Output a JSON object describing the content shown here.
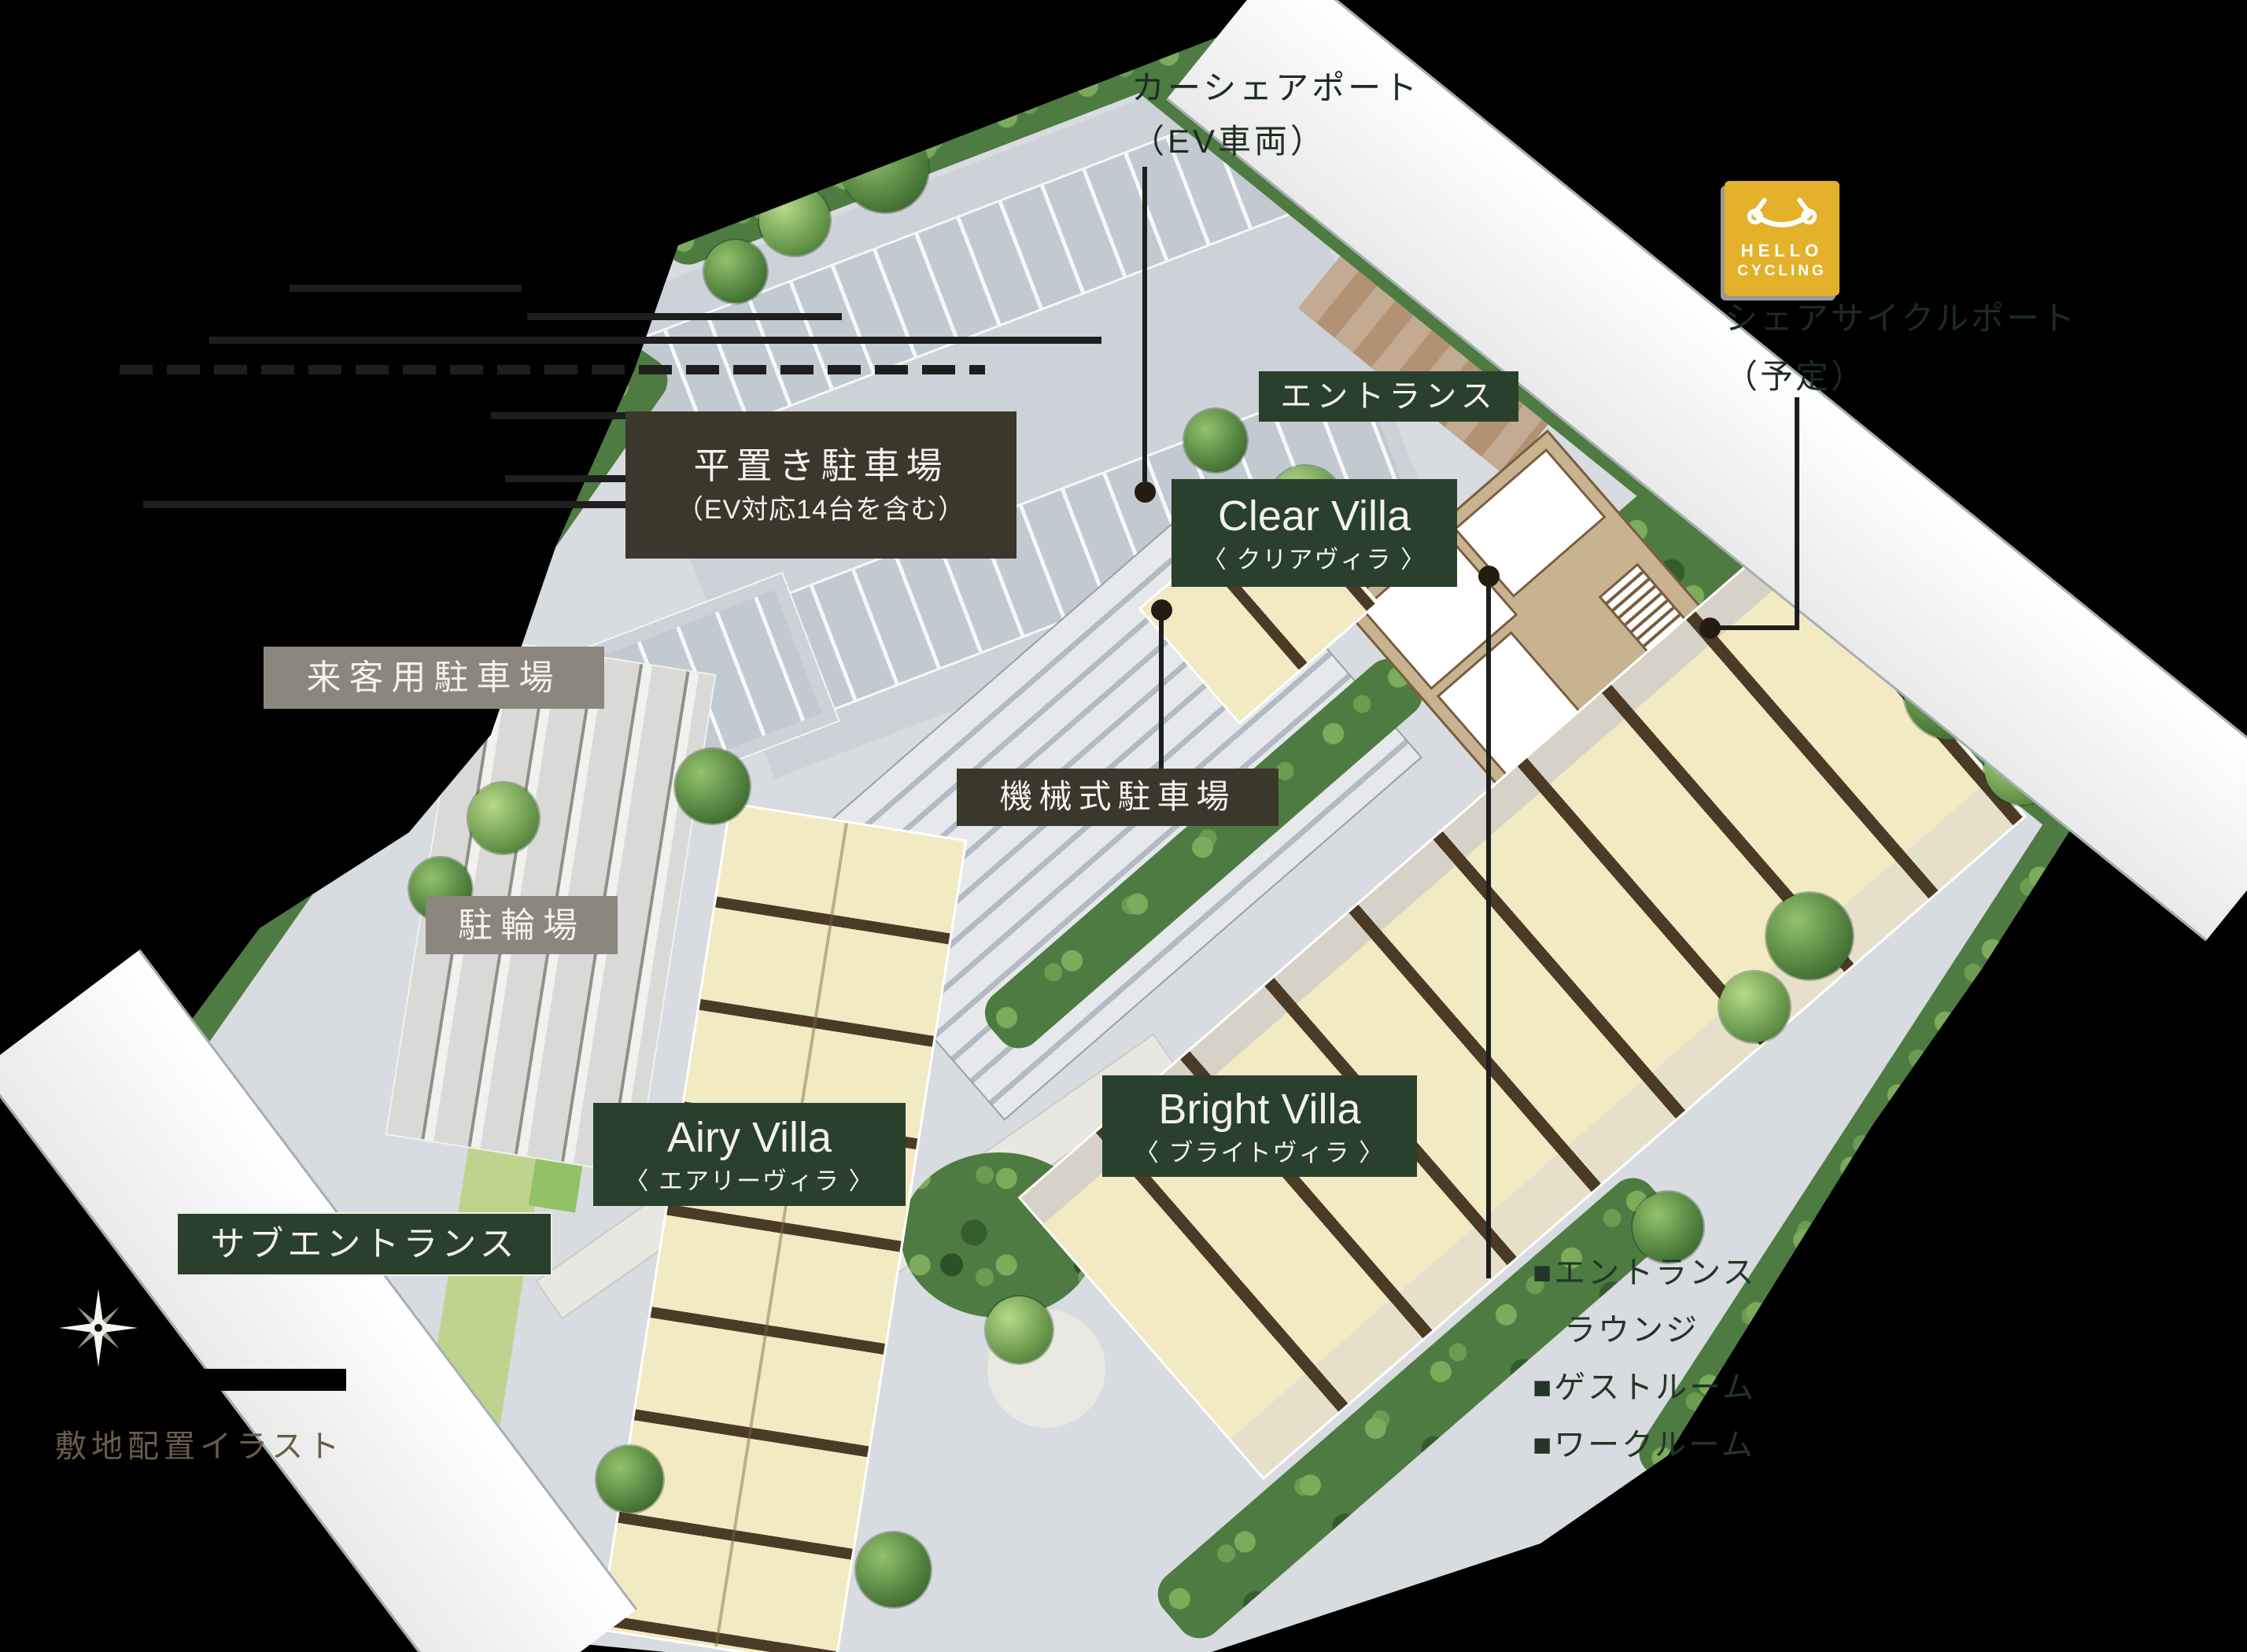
{
  "page": {
    "background": "#000000",
    "caption": "敷地配置イラスト"
  },
  "hello_cycling_badge": {
    "line1": "HELLO",
    "line2": "CYCLING",
    "bg": "#e4b12b"
  },
  "annotations": {
    "car_share_port": {
      "line1": "カーシェアポート",
      "line2": "（EV車両）"
    },
    "share_cycle_port": {
      "line1": "シェアサイクルポート",
      "line2": "（予定）"
    },
    "shared_facilities": [
      "■エントランス",
      "ラウンジ",
      "■ゲストルーム",
      "■ワークルーム"
    ]
  },
  "map_labels": {
    "flat_parking": {
      "line1": "平置き駐車場",
      "line2": "（EV対応14台を含む）"
    },
    "visitor_parking": "来客用駐車場",
    "entrance": "エントランス",
    "clear_villa": {
      "en": "Clear Villa",
      "ja": "〈 クリアヴィラ 〉"
    },
    "mechanical_parking": "機械式駐車場",
    "bicycle_parking": "駐輪場",
    "airy_villa": {
      "en": "Airy Villa",
      "ja": "〈 エアリーヴィラ 〉"
    },
    "bright_villa": {
      "en": "Bright Villa",
      "ja": "〈 ブライトヴィラ 〉"
    },
    "sub_entrance": "サブエントランス"
  },
  "colors": {
    "label_olive": "#3a372b",
    "label_green": "#28402c",
    "label_gray": "#8b877f",
    "building_cream": "#f1eac2",
    "building_wall": "#4a3a26",
    "clear_villa_tan": "#c8b391",
    "pavement_gray": "#ccd1d8",
    "road_white": "#fafafa",
    "hedge_green": "#4d7b41",
    "accent_yellow": "#e4b12b",
    "annotation_dark_green": "#1d2c21"
  }
}
